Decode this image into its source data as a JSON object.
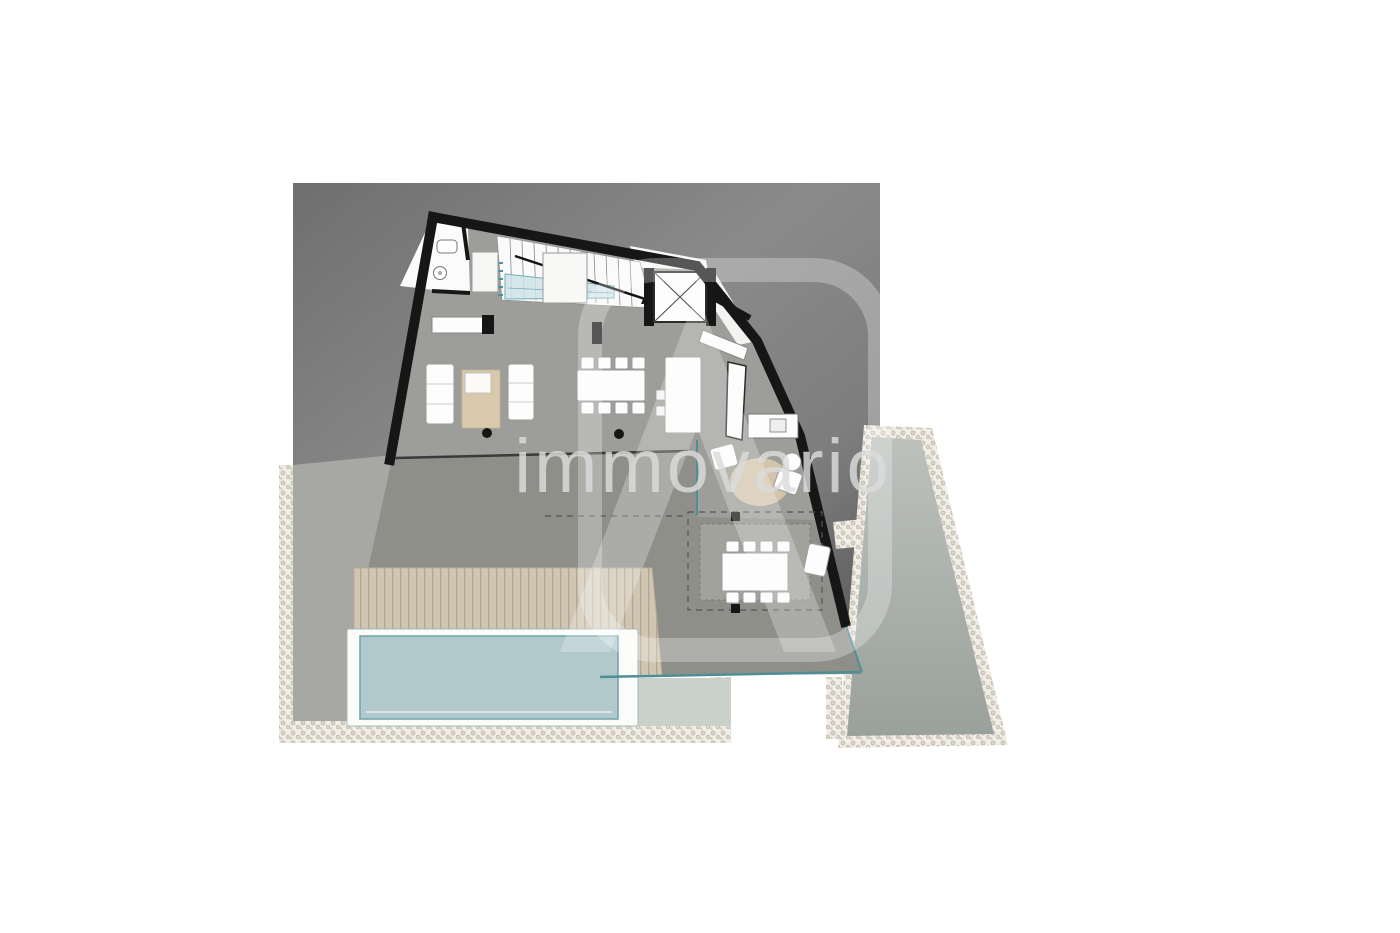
{
  "watermark": {
    "text": "immovario",
    "logo_icon": "immovario-a-logo"
  },
  "plan": {
    "type": "floor-plan",
    "visible_features": [
      "staircase",
      "elevator",
      "wc",
      "living-sofas",
      "dining-table",
      "kitchen-island",
      "outdoor-lounge",
      "pergola-dining",
      "wood-deck",
      "swimming-pool",
      "terrace",
      "gravel-border"
    ]
  },
  "colors": {
    "background": "#ffffff",
    "photo_dark": "#6f6f6f",
    "photo_mid": "#8a8a8a",
    "photo_deep": "#585858",
    "wall": "#161616",
    "interior_floor": "#9d9d99",
    "terrace": "#8f8f8a",
    "terrace_patch": "#a2a29c",
    "left_strip": "#a7a7a3",
    "deck_base": "#d0c6b3",
    "deck_stripe": "#b3a790",
    "pool_water": "#b1c9cd",
    "pool_frame": "#fbfbf9",
    "pool_edge": "#4e8f96",
    "pale_terrace": "#c9d1ca",
    "right_terrace_light": "#bcc1bd",
    "right_terrace_dark": "#9aa19c",
    "pebble_base": "#f1eee7",
    "pebble_stone": "#d9d4c8",
    "furniture": "#fdfdfd",
    "furniture_stroke": "#999691",
    "rug": "#d8c9ad",
    "stair_blue": "#cfe3e8",
    "stair_teal": "#4a96a0",
    "watermark": "#dcdcdc"
  }
}
